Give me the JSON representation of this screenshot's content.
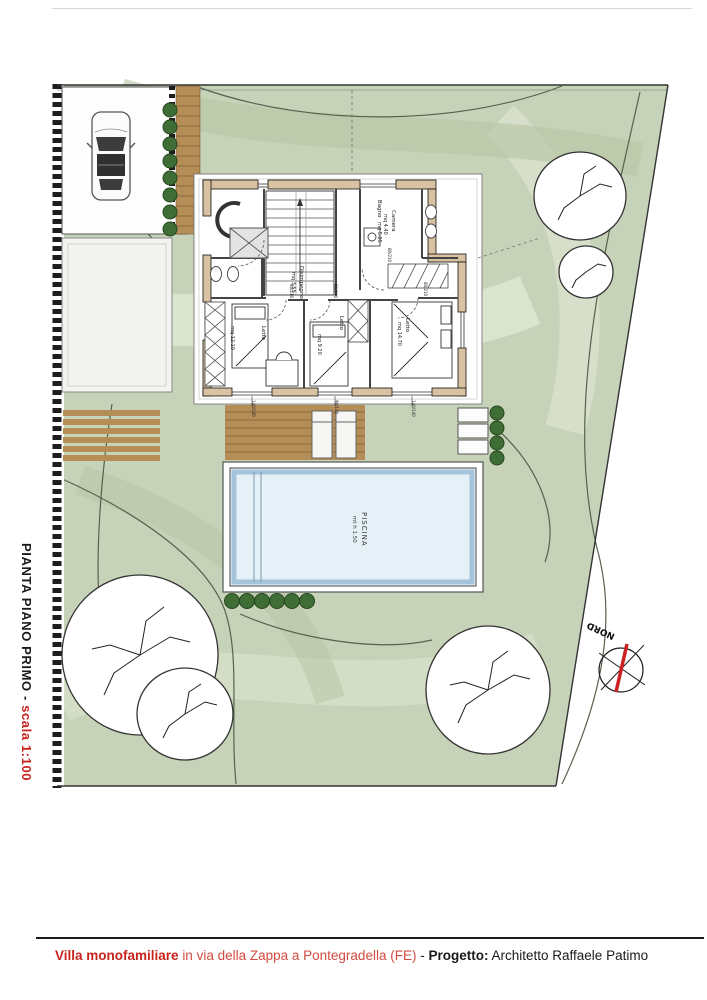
{
  "side_title": {
    "main": "PIANTA PIANO PRIMO - ",
    "scale": "scala 1:100"
  },
  "footer": {
    "title": "Villa monofamiliare",
    "location": "in via della Zappa a Pontegradella (FE)",
    "separator": "-",
    "project_label": "Progetto:",
    "architect": "Architetto Raffaele Patimo"
  },
  "plan": {
    "rooms": {
      "camera": {
        "name": "Camera",
        "area": "mq 4.40"
      },
      "bagno": {
        "name": "Bagno",
        "area": "mq 5.05"
      },
      "disimpegno": {
        "name": "Disimpegno",
        "area": "mq 3.55"
      },
      "letto1": {
        "name": "Letto",
        "area": "mq 12.10"
      },
      "letto2": {
        "name": "Letto",
        "area": "mq 9.20"
      },
      "letto3": {
        "name": "Letto",
        "area": "mq 14.70"
      }
    },
    "pool": {
      "name": "PISCINA",
      "size": "mt h 1.50"
    },
    "compass": {
      "label": "NORD"
    },
    "dims": {
      "doors": [
        "80/210",
        "80/210",
        "80/210",
        "80/210"
      ],
      "windows": [
        "140/140",
        "90/140",
        "140/140"
      ]
    }
  },
  "colors": {
    "accent_red": "#c8231d",
    "lawn": "#c7d3b9",
    "wood": "#b48d57",
    "wall_fill": "#d8c2a2",
    "pool_water": "#e6f1f7",
    "bush_green": "#3f6d36",
    "compass_needle": "#cc2222"
  }
}
